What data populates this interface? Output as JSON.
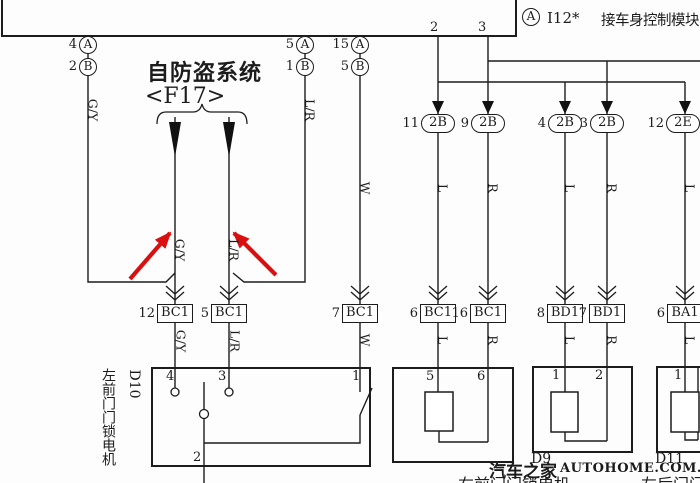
{
  "diagram": {
    "module": {
      "connector_circle": "A",
      "id": "I12*",
      "name": "接车身控制模块",
      "pin_left": "2",
      "pin_right": "3"
    },
    "antitheft": {
      "title": "自防盗系统",
      "code": "<F17>"
    },
    "module_pins": {
      "left": [
        {
          "num": "4",
          "circle": "A"
        },
        {
          "num": "2",
          "circle": "B"
        }
      ],
      "mid": [
        {
          "num": "5",
          "circle": "A"
        },
        {
          "num": "1",
          "circle": "B"
        }
      ],
      "right": [
        {
          "num": "15",
          "circle": "A"
        },
        {
          "num": "5",
          "circle": "B"
        }
      ]
    },
    "wire_labels": {
      "upper": [
        "G/Y",
        "L/R",
        "W",
        "L",
        "R",
        "L",
        "R",
        "L"
      ],
      "f17": [
        "G/Y",
        "L/R"
      ],
      "lower": [
        "G/Y",
        "L/R",
        "W",
        "L",
        "R",
        "L",
        "R",
        "L"
      ]
    },
    "ovals": [
      {
        "pin": "11",
        "id": "2B"
      },
      {
        "pin": "9",
        "id": "2B"
      },
      {
        "pin": "4",
        "id": "2B"
      },
      {
        "pin": "3",
        "id": "2B"
      },
      {
        "pin": "12",
        "id": "2E"
      }
    ],
    "connectors": [
      {
        "pin": "12",
        "id": "BC1"
      },
      {
        "pin": "5",
        "id": "BC1"
      },
      {
        "pin": "7",
        "id": "BC1"
      },
      {
        "pin": "6",
        "id": "BC1"
      },
      {
        "pin": "16",
        "id": "BC1"
      },
      {
        "pin": "8",
        "id": "BD1"
      },
      {
        "pin": "7",
        "id": "BD1"
      },
      {
        "pin": "6",
        "id": "BA1"
      }
    ],
    "d10": {
      "id": "D10",
      "name": "左前门门锁电机",
      "pin_4": "4",
      "pin_3": "3",
      "pin_1": "1",
      "pin_2": "2"
    },
    "box2": {
      "pin_5": "5",
      "pin_6": "6"
    },
    "d9": {
      "id": "D9",
      "pin_1": "1",
      "pin_2": "2",
      "name_partial": "右前门门锁电机"
    },
    "d11": {
      "id": "D11",
      "pin_1": "1",
      "name_partial": "左后门门锁电机"
    },
    "watermark": {
      "site": "汽车之家",
      "url": "AUTOHOME.COM.CN"
    }
  },
  "colors": {
    "line": "#1c1c1c",
    "highlight": "#da1010",
    "background": "#ffffff"
  }
}
